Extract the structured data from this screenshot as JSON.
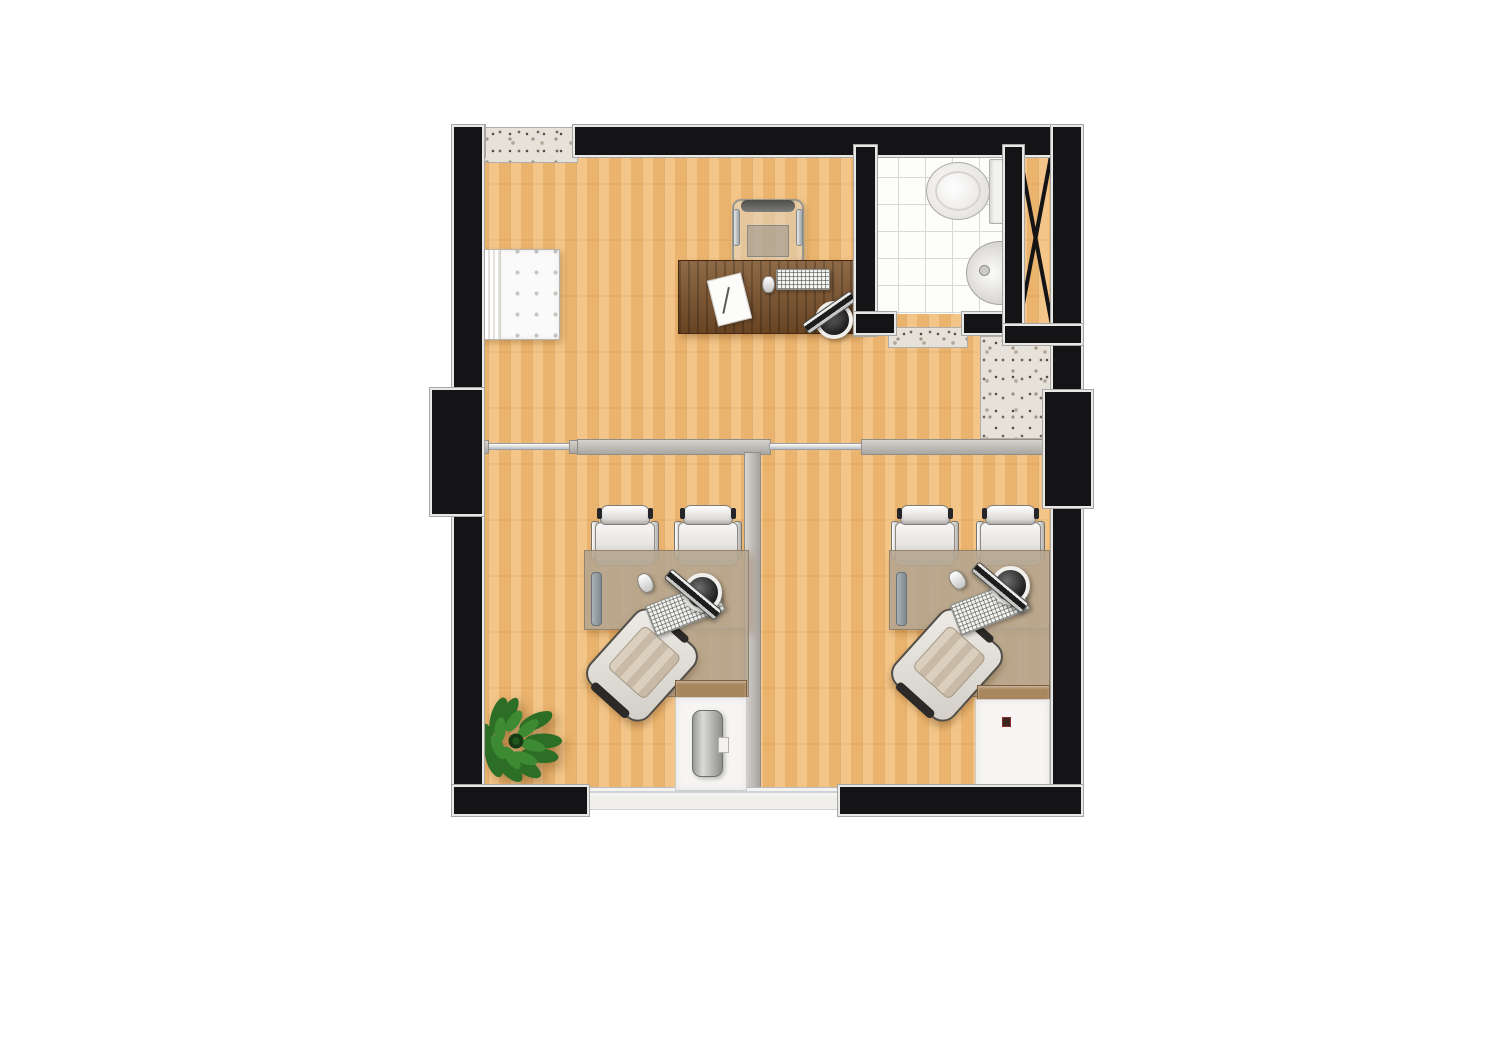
{
  "scene": {
    "type": "architectural-floor-plan",
    "view": "top-down-render",
    "visible_text": [],
    "rooms": [
      {
        "name": "main-office-reception",
        "floor": "wood-plank",
        "furniture": [
          "tufted-bench",
          "executive-desk",
          "executive-chair",
          "monitor",
          "keyboard",
          "mouse",
          "paper-sheet-with-pen"
        ],
        "features": [
          "window-with-granite-sill"
        ]
      },
      {
        "name": "bathroom",
        "floor": "white-ceramic-tile",
        "fixtures": [
          "toilet-with-tank",
          "wall-hung-sink"
        ],
        "features": [
          "granite-door-threshold"
        ]
      },
      {
        "name": "utility-shaft",
        "symbol": "x-cross-duct"
      },
      {
        "name": "hall-wash-area",
        "fixtures": [
          "granite-counter",
          "round-washbasin-with-faucet"
        ]
      },
      {
        "name": "office-room-left",
        "floor": "wood-plank",
        "furniture": [
          "l-shaped-desk",
          "task-chair",
          "visitor-chair",
          "visitor-chair",
          "monitor",
          "keyboard",
          "mouse",
          "low-cabinet",
          "water-cooler",
          "potted-plant"
        ]
      },
      {
        "name": "office-room-right",
        "floor": "wood-plank",
        "furniture": [
          "l-shaped-desk",
          "task-chair",
          "visitor-chair",
          "visitor-chair",
          "monitor",
          "keyboard",
          "mouse",
          "low-cabinet",
          "decor-gift-books"
        ]
      },
      {
        "name": "balcony-terrace",
        "floor": "concrete-slab",
        "features": [
          "sliding-glass-door"
        ]
      }
    ],
    "structure": [
      "black-masonry-walls-with-light-trim",
      "left-pillar",
      "right-pillar",
      "gray-stud-partitions",
      "glass-partition-segment",
      "room-divider-wall"
    ]
  },
  "palette": {
    "wood_floor": "#efb76f",
    "desk_wood": "#7c5129",
    "wall_black": "#141417",
    "wall_trim": "#e8e8e6",
    "partition_gray": "#b9b5b0",
    "tile_white": "#fdfdfc",
    "tile_line": "#d8d8d4",
    "granite_base": "#e6e2da",
    "balcony_gray": "#c8c4bf",
    "balcony_edge": "#dcd9d4",
    "plant_green_dark": "#24571f",
    "plant_green_light": "#3c8a31",
    "accent_red": "#a8293d",
    "chair_white": "#f6f5f3",
    "glass_blue": "#ccd3d8"
  }
}
